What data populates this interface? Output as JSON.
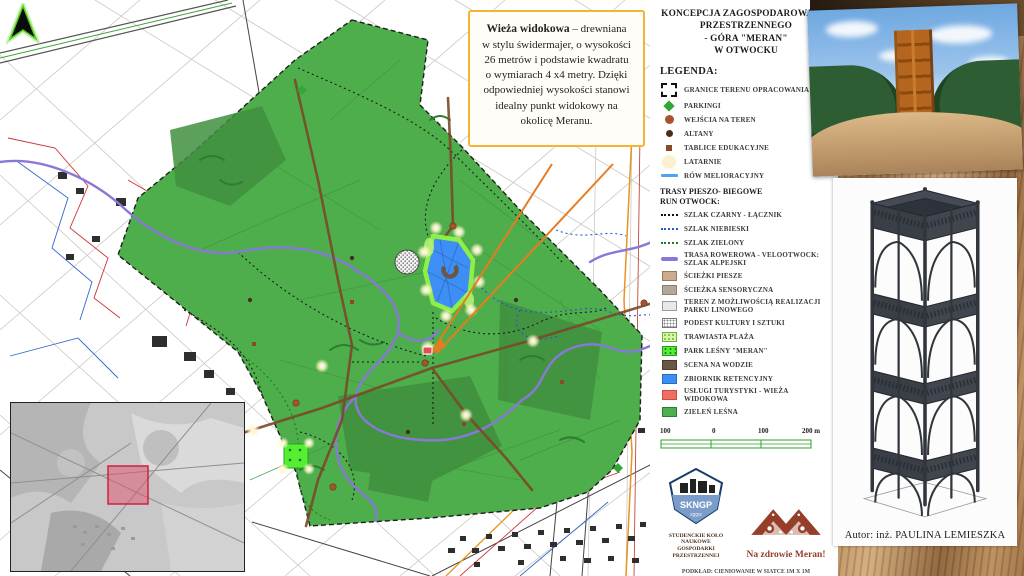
{
  "poster": {
    "info_box": {
      "lead": "Wieża widokowa",
      "body": " – drewniana w stylu świdermajer, o wysokości 26 metrów i podstawie kwadratu o wymiarach 4 x4 metry. Dzięki odpowiedniej wysokości stanowi idealny punkt widokowy na okolicę Meranu."
    },
    "title_lines": [
      "KONCEPCJA ZAGOSPODAROWANIA",
      "PRZESTRZENNEGO",
      "- GÓRA \"MERAN\"",
      "W OTWOCKU"
    ],
    "legend_heading": "LEGENDA:",
    "legend_items": [
      {
        "icon": "dashed-boundary-swatch",
        "label": "GRANICE TERENU OPRACOWANIA"
      },
      {
        "icon": "green-diamond-swatch",
        "label": "PARKINGI"
      },
      {
        "icon": "rust-circle-swatch",
        "label": "WEJŚCIA NA TEREN"
      },
      {
        "icon": "darkbrown-circle-swatch",
        "label": "ALTANY"
      },
      {
        "icon": "brown-square-swatch",
        "label": "TABLICE EDUKACYJNE"
      },
      {
        "icon": "cream-circle-swatch",
        "label": "LATARNIE"
      },
      {
        "icon": "blue-line-swatch",
        "label": "RÓW MELIORACYJNY"
      }
    ],
    "trails_heading_lines": [
      "TRASY PIESZO- BIEGOWE",
      "RUN OTWOCK:"
    ],
    "trail_items": [
      {
        "icon": "black-dotted-swatch",
        "label": "SZLAK CZARNY - ŁĄCZNIK"
      },
      {
        "icon": "blue-dotted-swatch",
        "label": "SZLAK NIEBIESKI"
      },
      {
        "icon": "green-dotted-swatch",
        "label": "SZLAK ZIELONY"
      },
      {
        "icon": "purple-line-swatch",
        "label": "TRASA ROWEROWA - VELOOTWOCK: SZLAK ALPEJSKI"
      },
      {
        "icon": "tan-area-swatch",
        "label": "ŚCIEŻKI PIESZE"
      },
      {
        "icon": "graybrown-area-swatch",
        "label": "ŚCIEŻKA SENSORYCZNA"
      },
      {
        "icon": "lightgray-area-swatch",
        "label": "TEREN Z MOŻLIWOŚCIĄ REALIZACJI PARKU LINOWEGO"
      },
      {
        "icon": "hatched-area-swatch",
        "label": "PODEST KULTURY I SZTUKI"
      },
      {
        "icon": "lightgreen-dotted-area-swatch",
        "label": "TRAWIASTA PLAŻA"
      },
      {
        "icon": "brightgreen-dotted-area-swatch",
        "label": "PARK LEŚNY \"MERAN\""
      },
      {
        "icon": "darkbrown-area-swatch",
        "label": "SCENA NA WODZIE"
      },
      {
        "icon": "blue-area-swatch",
        "label": "ZBIORNIK RETENCYJNY"
      },
      {
        "icon": "red-area-swatch",
        "label": "USŁUGI TURYSTYKI - WIEŻA WIDOKOWA"
      },
      {
        "icon": "green-area-swatch",
        "label": "ZIELEŃ LEŚNA"
      }
    ],
    "scale_bar": {
      "labels": [
        "100",
        "0",
        "100",
        "200 m"
      ]
    },
    "logos": {
      "skngp": {
        "acronym": "SKNGP",
        "university": "sggw",
        "caption_lines": [
          "STUDENCKIE KOŁO NAUKOWE",
          "GOSPODARKI PRZESTRZENNEJ"
        ]
      },
      "meran": {
        "caption": "Na zdrowie Meran!"
      }
    },
    "footnote_lines": [
      "PODKŁAD: CIENIOWANIE W SIATCE 1M X 1M",
      "EPSG 2180"
    ],
    "author": "Autor: inż. PAULINA LEMIESZKA"
  },
  "colors": {
    "park_green": "#4fae4c",
    "dark_forest_green": "#3f8f3e",
    "water_blue": "#3d8ef5",
    "beach_green": "#8ef046",
    "bike_trail_purple": "#8a78d8",
    "path_brown": "#7a4a28",
    "leader_orange": "#e87b20",
    "info_box_border": "#f5b431",
    "tower_marker_red": "#e35050",
    "inset_highlight_pink": "#d03050"
  }
}
